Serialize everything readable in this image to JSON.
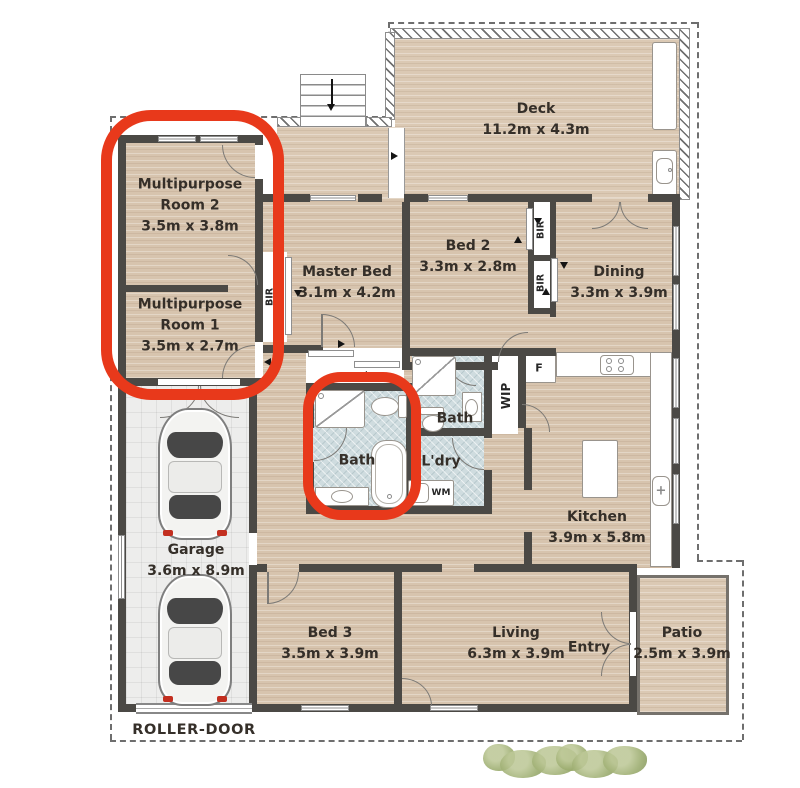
{
  "highlight_color": "#e8391b",
  "rooms": {
    "deck": {
      "name": "Deck",
      "dims": "11.2m x 4.3m"
    },
    "mp2": {
      "line1": "Multipurpose",
      "line2": "Room 2",
      "dims": "3.5m x 3.8m"
    },
    "mp1": {
      "line1": "Multipurpose",
      "line2": "Room 1",
      "dims": "3.5m x 2.7m"
    },
    "master": {
      "name": "Master Bed",
      "dims": "3.1m x 4.2m"
    },
    "bed2": {
      "name": "Bed 2",
      "dims": "3.3m x 2.8m"
    },
    "dining": {
      "name": "Dining",
      "dims": "3.3m x 3.9m"
    },
    "bath_main": {
      "name": "Bath"
    },
    "bath_ensuite": {
      "name": "Bath"
    },
    "laundry": {
      "name": "L'dry"
    },
    "kitchen": {
      "name": "Kitchen",
      "dims": "3.9m x 5.8m"
    },
    "garage": {
      "name": "Garage",
      "dims": "3.6m x 8.9m"
    },
    "bed3": {
      "name": "Bed 3",
      "dims": "3.5m x 3.9m"
    },
    "living": {
      "name": "Living",
      "dims": "6.3m x 3.9m"
    },
    "entry": {
      "name": "Entry"
    },
    "patio": {
      "name": "Patio",
      "dims": "2.5m x 3.9m"
    }
  },
  "labels": {
    "roller_door": "ROLLER-DOOR",
    "bir": "BIR",
    "wm": "WM",
    "wip": "WIP",
    "fridge": "F"
  }
}
